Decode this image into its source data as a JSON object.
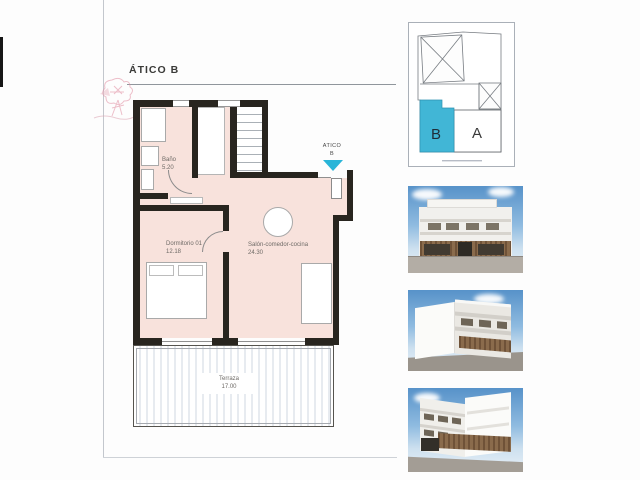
{
  "document": {
    "title": "ÁTICO B",
    "watermark_icon": "inmobiliaria-rose-logo"
  },
  "floor_plan": {
    "fill_color": "#f8e2dc",
    "wall_color": "#28251f",
    "arrow_color": "#29b5d8",
    "rooms": [
      {
        "name": "Baño",
        "area": "5.20"
      },
      {
        "name": "Dormitorio 01",
        "area": "12.18"
      },
      {
        "name": "Salón-comedor-cocina",
        "area": "24.30"
      },
      {
        "name": "Terraza",
        "area": "17.00"
      }
    ],
    "entrance": {
      "label_line1": "ATICO",
      "label_line2": "B"
    }
  },
  "key_plan": {
    "unit_b_label": "B",
    "unit_a_label": "A",
    "highlight_color": "#41b6d6"
  }
}
